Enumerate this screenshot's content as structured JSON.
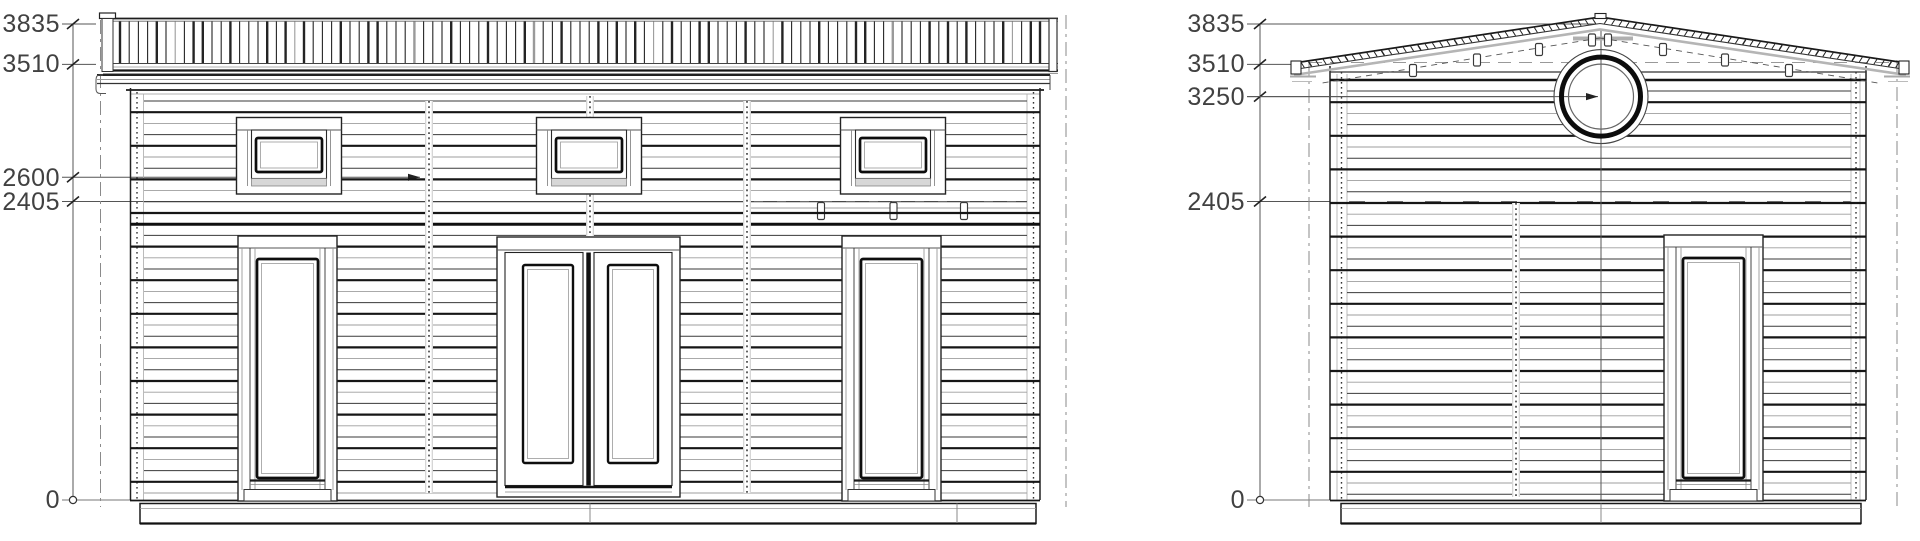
{
  "page": {
    "background": "#ffffff",
    "description": "Architectural elevation drawings of a log cabin: front elevation with balcony railing, and gable side elevation with round window"
  },
  "drawing": {
    "line_color": "#222222",
    "accent_gray": "#999999",
    "scale_px_per_mm": 0.12412,
    "baseline_y": 500,
    "front_elevation": {
      "name": "front elevation",
      "dimensions": [
        {
          "text": "3835",
          "mm": 3835
        },
        {
          "text": "3510",
          "mm": 3510
        },
        {
          "text": "2600",
          "mm": 2600
        },
        {
          "text": "2405",
          "mm": 2405
        },
        {
          "text": "0",
          "mm": 0
        }
      ],
      "window_count": 3,
      "door_count": 3
    },
    "side_elevation": {
      "name": "side elevation",
      "dimensions": [
        {
          "text": "3835",
          "mm": 3835
        },
        {
          "text": "3510",
          "mm": 3510
        },
        {
          "text": "3250",
          "mm": 3250
        },
        {
          "text": "2405",
          "mm": 2405
        },
        {
          "text": "0",
          "mm": 0
        }
      ],
      "round_window_level_mm": 3250,
      "door_count": 1
    }
  }
}
